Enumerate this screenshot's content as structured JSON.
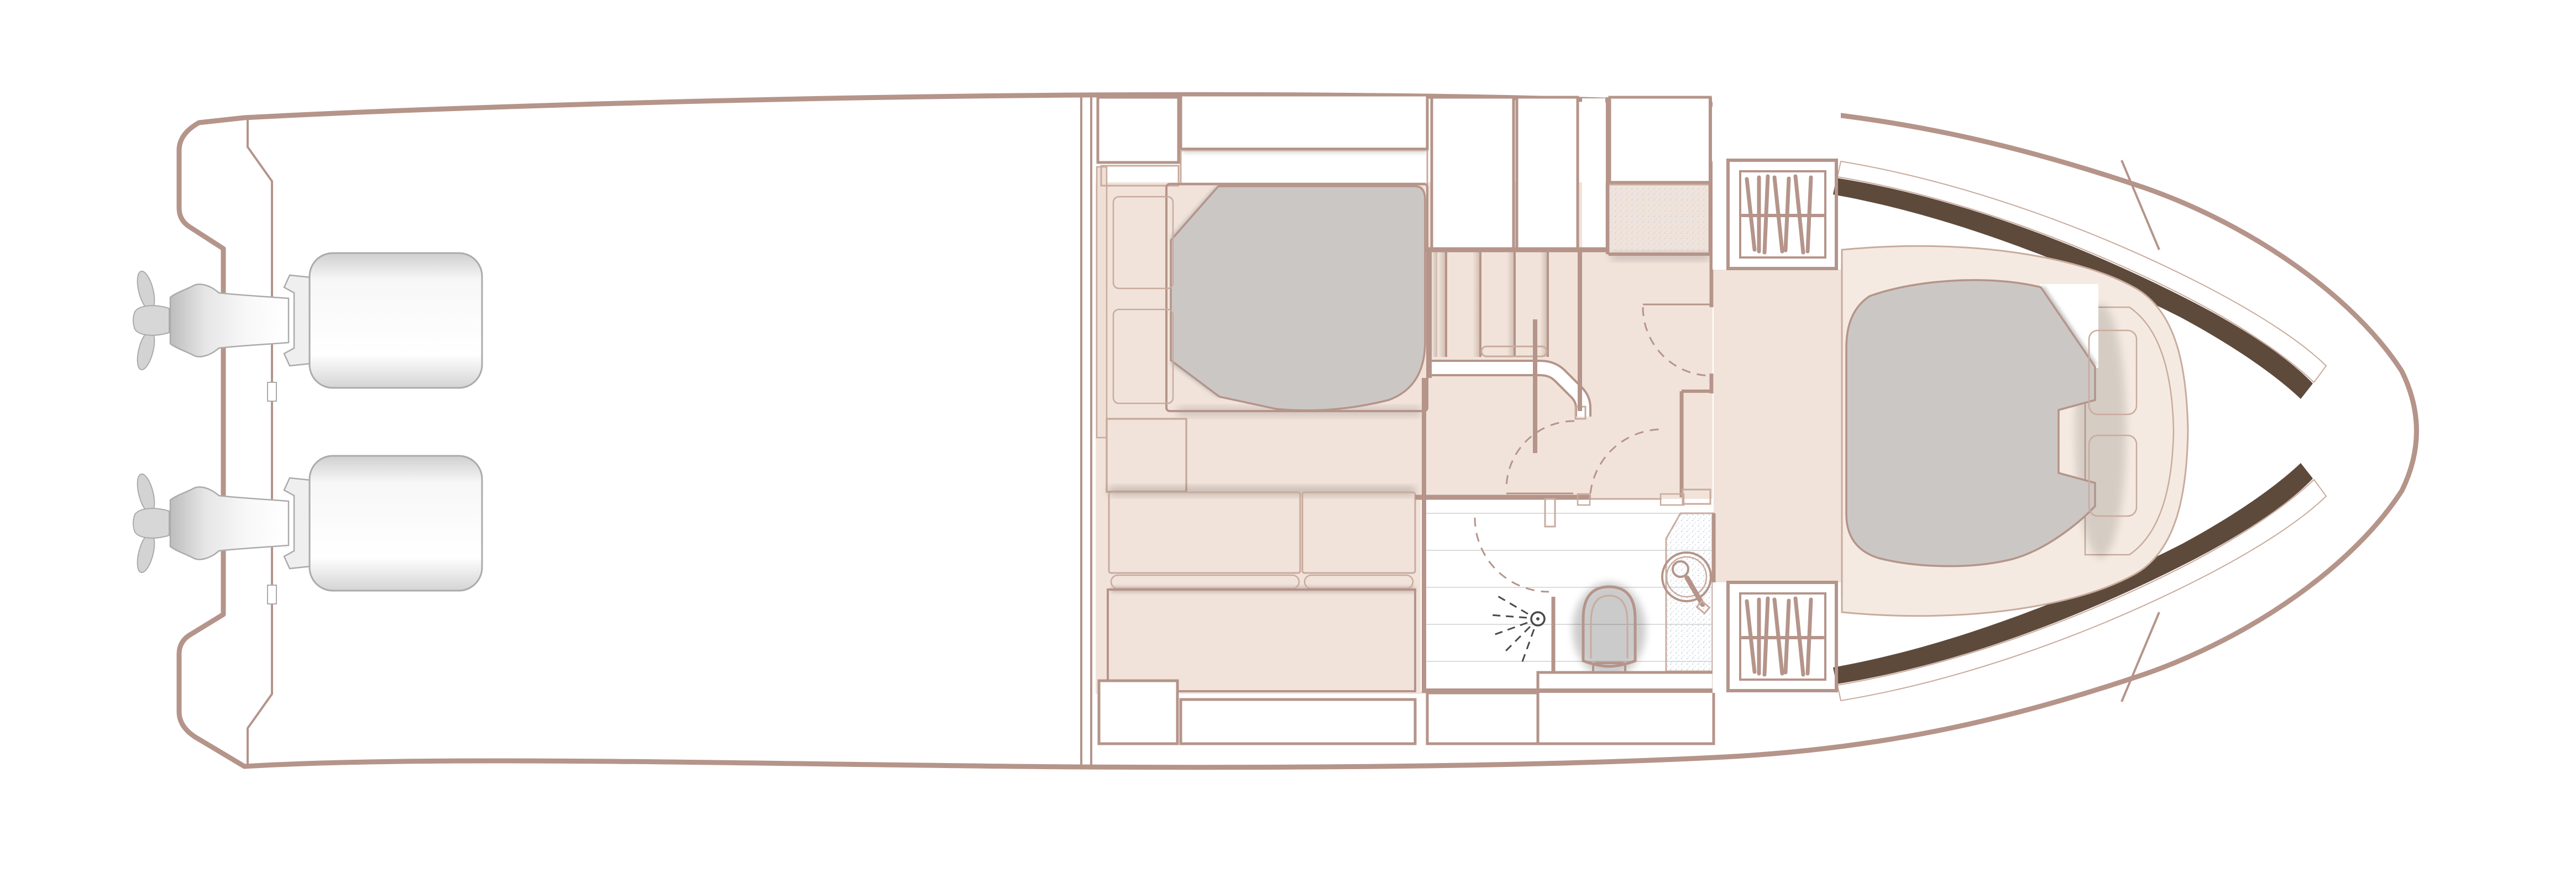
{
  "meta": {
    "type": "yacht-lower-deck-floor-plan",
    "description": "Top-view general arrangement plan of a motor yacht lower deck: twin outboard engines on the transom, empty cockpit, midship double cabin with bed, sofa and wood table, central staircase lobby, bathroom with shower, toilet and round basin, and a forward V-berth cabin with two hanging wardrobes"
  },
  "palette": {
    "wall": "#b5948a",
    "wall_thin": "#c9ab9d",
    "floor": "#f1e3da",
    "floor_strip": "#efe0d7",
    "cream": "#f4eae1",
    "cushion_hi": "#faf5ef",
    "cushion_lo": "#eddccf",
    "wood_light": "#f4dcba",
    "wood_mid": "#e5b277",
    "wood_dark": "#d2914f",
    "trim_dark": "#5e4a3b",
    "mattress": "#cbc7c4",
    "mattress_line": "#dedad6",
    "pillow_edge": "#b3b3b3",
    "speck_dot": "#c6d2df",
    "fixture": "#4a4a4a",
    "engine_stroke": "#ababab",
    "engine_fill": "#e6e6e6"
  },
  "inventory": {
    "hull": {
      "bow_tip": "starboard-right",
      "stern": "left",
      "swim_platform_notches": 2
    },
    "engines": {
      "count": 2,
      "type": "outboard",
      "position": "transom"
    },
    "mid_cabin": {
      "bed": {
        "pillows": 2,
        "quilted": true,
        "turned_corners": 2
      },
      "headboard": "wood",
      "sofa_cushions": 2,
      "wood_table": 1,
      "storage_lockers": 6
    },
    "lobby": {
      "stair_treads": 5,
      "handrail": 1,
      "balustrade": 1,
      "doors": 4,
      "counter_speckled": 1
    },
    "bathroom": {
      "shower_spray": 1,
      "toilet": 1,
      "round_basin": 1,
      "vanity_speckled": 1,
      "floor_planks": 5
    },
    "forward_cabin": {
      "v_berth": {
        "pillows": 2,
        "quilted": true,
        "turned_corner": 1
      },
      "wardrobes_with_hangers": 2,
      "hull_trim_bands": 2
    }
  }
}
